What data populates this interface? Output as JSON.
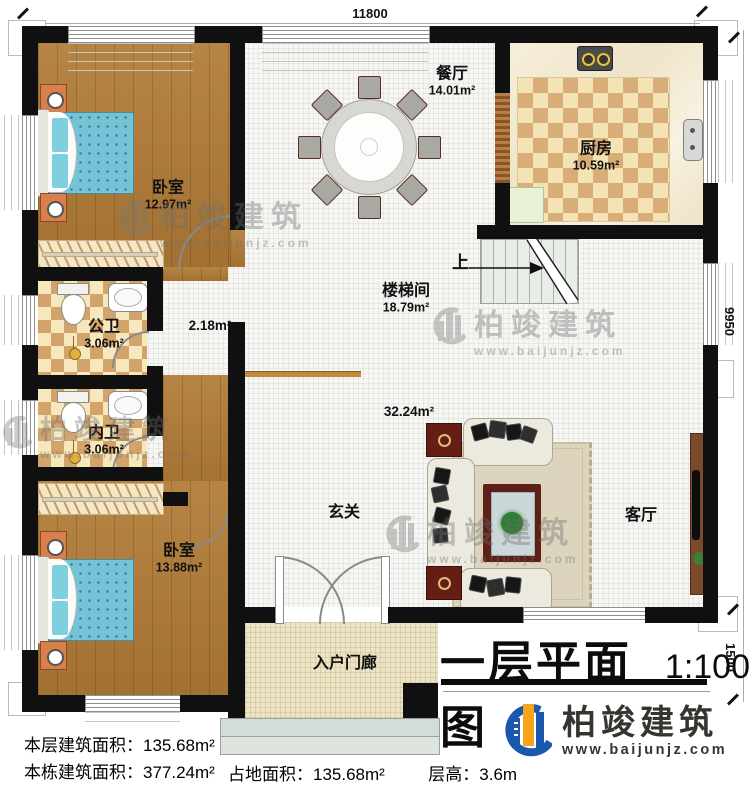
{
  "plan": {
    "title": "一层平面图",
    "scale": "1:100",
    "up_label": "上"
  },
  "dimensions": {
    "top_width": "11800",
    "right_upper": "9950",
    "right_lower": "1500"
  },
  "rooms": {
    "bedroom1": {
      "name": "卧室",
      "area": "12.97m²"
    },
    "dining": {
      "name": "餐厅",
      "area": "14.01m²"
    },
    "kitchen": {
      "name": "厨房",
      "area": "10.59m²"
    },
    "stairwell": {
      "name": "楼梯间",
      "area": "18.79m²"
    },
    "hallway": {
      "area": "2.18m²"
    },
    "bath_public": {
      "name": "公卫",
      "area": "3.06m²"
    },
    "bath_private": {
      "name": "内卫",
      "area": "3.06m²"
    },
    "bedroom2": {
      "name": "卧室",
      "area": "13.88m²"
    },
    "foyer": {
      "name": "玄关"
    },
    "living": {
      "name": "客厅",
      "area": "32.24m²"
    },
    "porch": {
      "name": "入户门廊"
    }
  },
  "stats": {
    "line1": {
      "label": "本层建筑面积：",
      "value": "135.68m²"
    },
    "line2": {
      "label": "本栋建筑面积：",
      "value": "377.24m²"
    },
    "line3": {
      "label": "占地面积：",
      "value": "135.68m²"
    },
    "line4": {
      "label": "层高：",
      "value": "3.6m"
    }
  },
  "branding": {
    "company": "柏竣建筑",
    "website": "www.baijunjz.com"
  },
  "watermark": {
    "company": "柏竣建筑",
    "website": "www.baijunjz.com"
  },
  "colors": {
    "wall": "#101010",
    "wood_floor": "#b07b36",
    "tile_tan": "#d2a36b",
    "bed_blue": "#74c3d6",
    "logo_blue": "#1b57ad",
    "logo_orange": "#f7a41d"
  }
}
